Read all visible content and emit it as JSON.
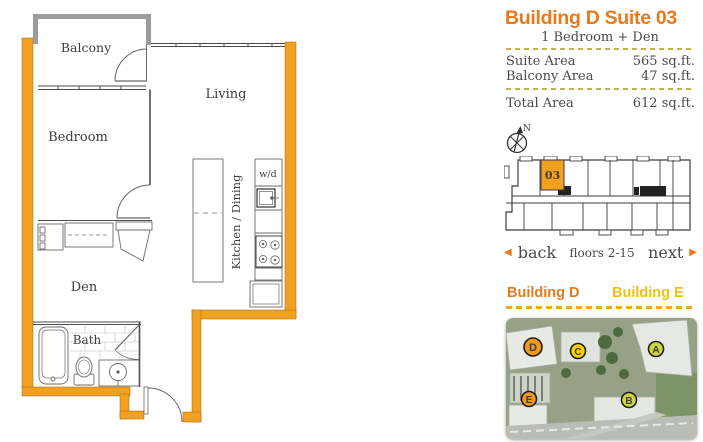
{
  "suite_info": {
    "title": "Building D Suite 03",
    "subtitle": "1 Bedroom + Den",
    "area_rows": [
      {
        "label": "Suite Area",
        "value": "565 sq.ft."
      },
      {
        "label": "Balcony Area",
        "value": "47 sq.ft."
      }
    ],
    "total_row": {
      "label": "Total Area",
      "value": "612 sq.ft."
    }
  },
  "keyplan": {
    "suite_number": "03",
    "north_label": "N",
    "highlight_color": "#F2A01F"
  },
  "pager": {
    "back_label": "back",
    "floors_label": "floors 2-15",
    "next_label": "next",
    "back_arrow": "◀",
    "next_arrow": "▶"
  },
  "site": {
    "building_left_label": "Building D",
    "building_right_label": "Building E",
    "markers": [
      {
        "letter": "D",
        "color": "#F2991D"
      },
      {
        "letter": "C",
        "color": "#FFD100"
      },
      {
        "letter": "A",
        "color": "#CDD63B"
      },
      {
        "letter": "E",
        "color": "#F2991D"
      },
      {
        "letter": "B",
        "color": "#CDD63B"
      }
    ]
  },
  "floor_plan": {
    "wall_color": "#F2A01F",
    "labels": {
      "balcony": "Balcony",
      "living": "Living",
      "bedroom": "Bedroom",
      "den": "Den",
      "bath": "Bath",
      "kitchen": "Kitchen / Dining",
      "washer_dryer": "w/d"
    }
  },
  "colors": {
    "accent_orange": "#E87A1C",
    "accent_yellow": "#F2C014"
  }
}
